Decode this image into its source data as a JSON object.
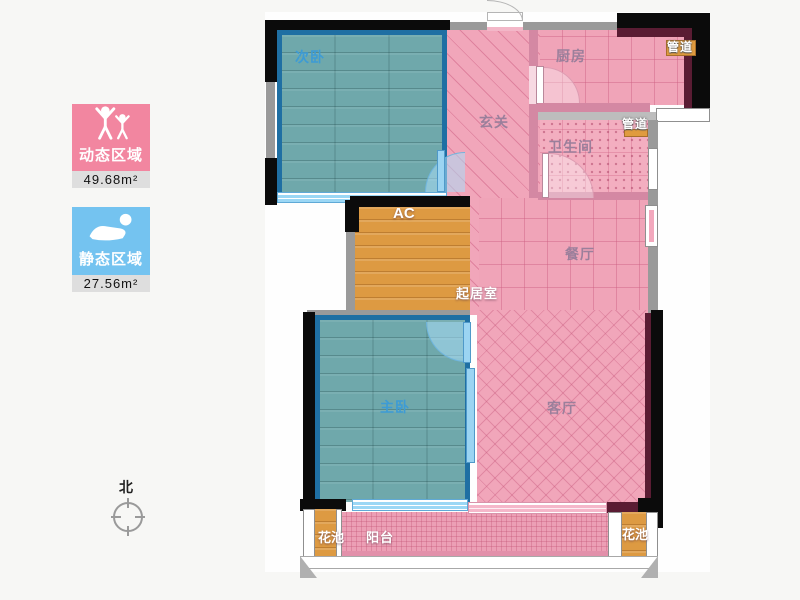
{
  "legend": {
    "dynamic_label": "动态区域",
    "dynamic_area": "49.68m²",
    "dynamic_color": "#f286a0",
    "static_label": "静态区域",
    "static_area": "27.56m²",
    "static_color": "#74c3f0"
  },
  "compass_label": "北",
  "rooms": {
    "secondary_bedroom": "次卧",
    "kitchen": "厨房",
    "duct_top_right": "管道",
    "entrance_hall": "玄关",
    "bathroom": "卫生间",
    "duct_bathroom": "管道",
    "ac_shaft": "AC",
    "dining_room": "餐厅",
    "living_core": "起居室",
    "master_bedroom": "主卧",
    "living_room": "客厅",
    "flower_bed_left": "花池",
    "balcony": "阳台",
    "flower_bed_right": "花池"
  },
  "colors": {
    "bedroom_fill": "#6fa8ab",
    "public_fill": "#f1a6ba",
    "shaft_fill": "#dd9a42",
    "wall": "#0b0b0b",
    "room_border": "#1f6fa3"
  }
}
